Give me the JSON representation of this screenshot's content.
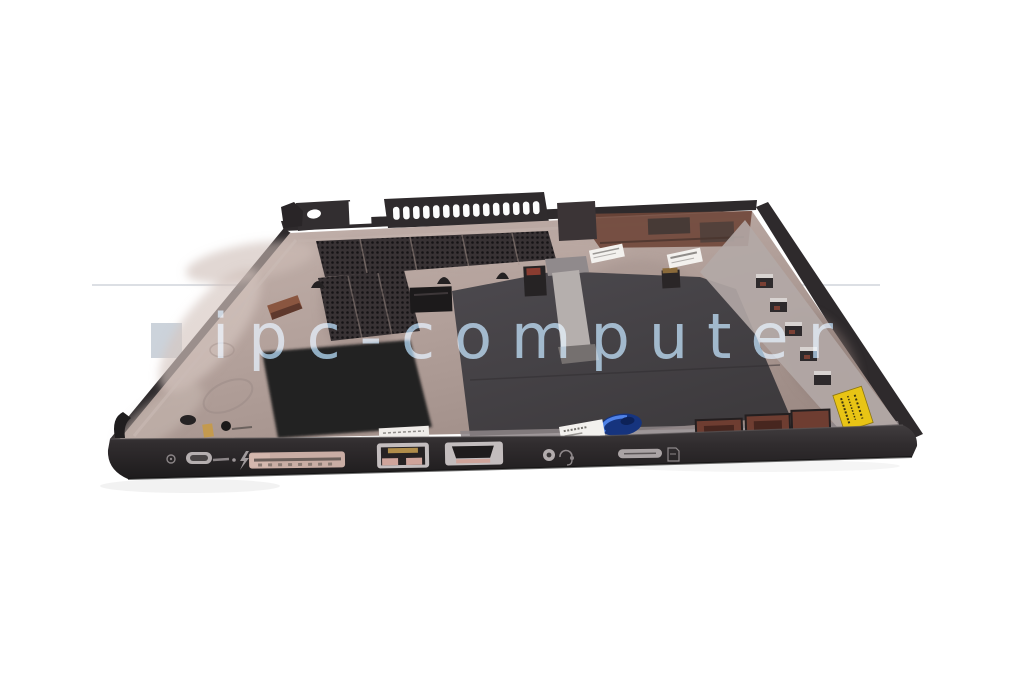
{
  "scene": {
    "type": "product-photo",
    "subject": "laptop bottom case (base cover) interior, tilted view on white background",
    "background": "#ffffff"
  },
  "watermark": {
    "text": "ipc-computer"
  },
  "palette": {
    "case_rim": "#2e2a2c",
    "wall_top": "#413d3f",
    "wall_bottom": "#1d1b1c",
    "interior_light": "#c6b5af",
    "interior_mid": "#a7958e",
    "mesh_dark": "#37322f",
    "foam_black": "#232021",
    "mylar_sheet": "#474449",
    "hinge_red_brown": "#6f4639",
    "compartment_red": "#6e3d31",
    "dock_connector_pink": "#c9ada4",
    "port_frame_gray": "#c3bdbe",
    "pin_pink": "#cfa49b",
    "pin_gold": "#b08d4a",
    "sticker_yellow": "#e8c415",
    "badge_blue": "#16347e",
    "label_white": "#f3f1ee",
    "watermark_text": "#8fb3cf",
    "watermark_square": "#ccd3db",
    "watermark_line": "#dcdfe4"
  },
  "icons": [
    "power-icon",
    "thunderbolt-icon",
    "headset-jack-icon",
    "sim-icon"
  ]
}
